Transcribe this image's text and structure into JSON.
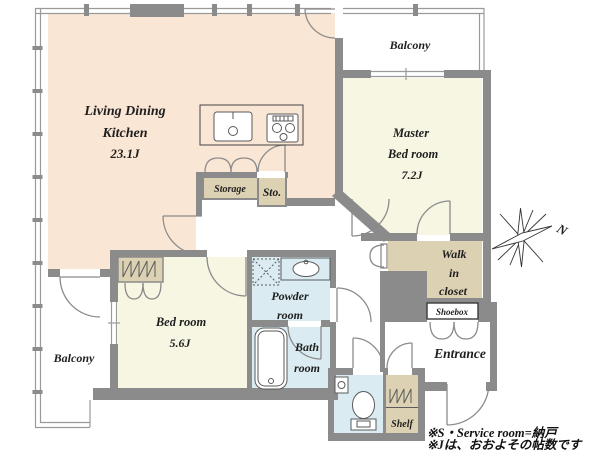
{
  "plan": {
    "rooms": {
      "ldk": {
        "l1": "Living Dining",
        "l2": "Kitchen",
        "size": "23.1J"
      },
      "balcony_top": {
        "label": "Balcony"
      },
      "master": {
        "l1": "Master",
        "l2": "Bed room",
        "size": "7.2J"
      },
      "wic": {
        "l1": "Walk",
        "l2": "in",
        "l3": "closet"
      },
      "shoebox": {
        "label": "Shoebox"
      },
      "entrance": {
        "label": "Entrance"
      },
      "shelf": {
        "label": "Shelf"
      },
      "bedroom": {
        "l1": "Bed room",
        "size": "5.6J"
      },
      "bath": {
        "l1": "Bath",
        "l2": "room"
      },
      "powder": {
        "l1": "Powder",
        "l2": "room"
      },
      "balcony_bottom": {
        "label": "Balcony"
      },
      "storage": {
        "label": "Storage"
      },
      "sto": {
        "label": "Sto."
      }
    },
    "compass": {
      "label": "N"
    },
    "notes": {
      "l1": "※S・Service room=納戸",
      "l2": "※Jは、おおよその帖数です"
    },
    "colors": {
      "peach": "#fae6d4",
      "yellow": "#f7f6e3",
      "tan": "#dcd1b2",
      "blue": "#daecf2",
      "wall": "#8b8b8b",
      "line": "#9a9a9a",
      "fixture": "#5a5a5a",
      "text": "#1f1f1f"
    },
    "icons": {
      "kitchen_sink": "sink-icon",
      "stove": "stove-icon",
      "bathtub": "bathtub-icon",
      "toilet": "toilet-icon",
      "wash_basin": "basin-icon",
      "washer_space": "washing-machine-icon",
      "closet_hangers": "closet-hanger-icon",
      "compass_star": "compass-icon"
    }
  }
}
